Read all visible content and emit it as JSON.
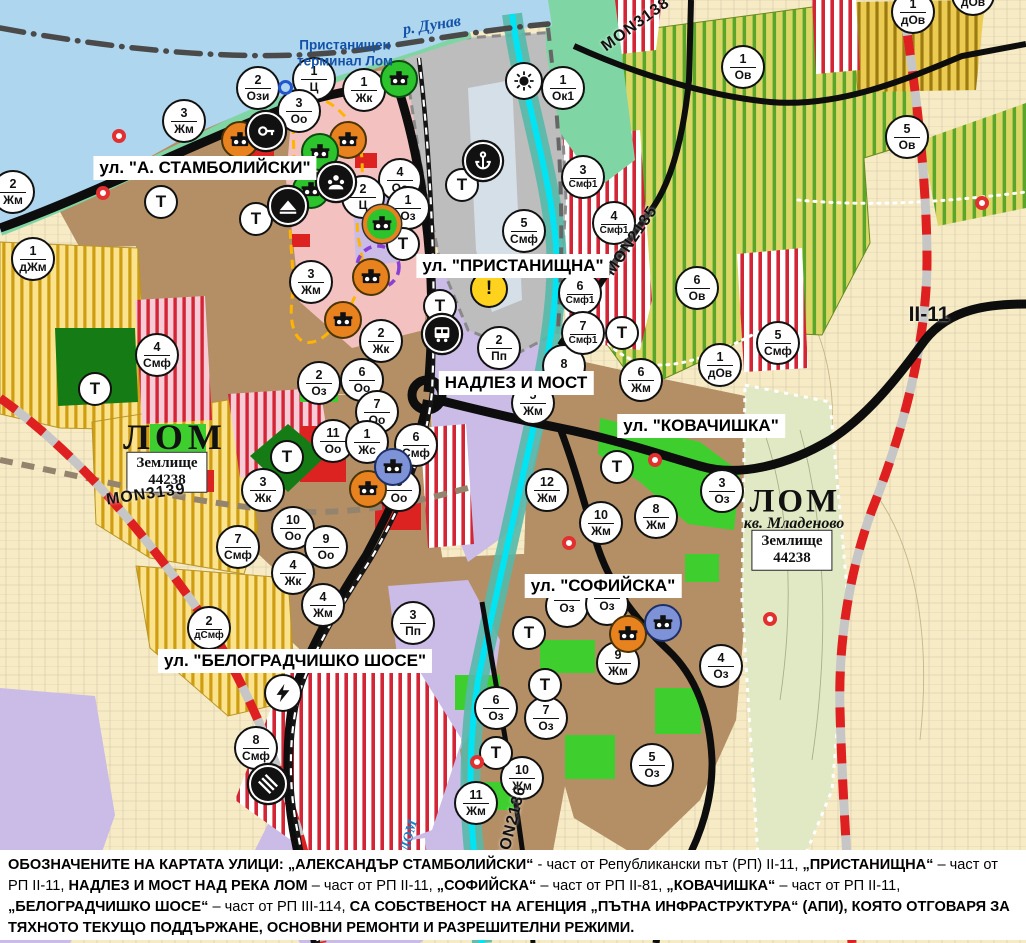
{
  "palette": {
    "water": "#aed6ee",
    "shore_green": "#7fd6a4",
    "urban_brown": "#b48f67",
    "pink_zone": "#f3c2c0",
    "agri_yellow": "#fbe28c",
    "agri_stripe": "#cf9d12",
    "vine_bg": "#dad766",
    "vine_stripe": "#5aa62a",
    "gold_bg": "#eccb52",
    "gold_stripe": "#9c7b10",
    "red_stripe": "#d32535",
    "lavender": "#cabbe7",
    "port_gray": "#bdbdbd",
    "bright_green": "#3ecf2e",
    "dark_green": "#157c15",
    "valley": "#e0e9c4",
    "beige": "#f6ebc5",
    "cyan_river": "#00e4f4",
    "teal_band": "#55b9a9",
    "road_black": "#0d0d0d",
    "border_red": "#df2020",
    "marker_orange": "#e8821e",
    "marker_green": "#2cc32c",
    "marker_blue": "#7e92d8"
  },
  "street_labels": [
    {
      "text": "ул. \"А. СТАМБОЛИЙСКИ\"",
      "x": 205,
      "y": 168
    },
    {
      "text": "ул. \"ПРИСТАНИЩНА\"",
      "x": 513,
      "y": 266
    },
    {
      "text": "НАДЛЕЗ И МОСТ",
      "x": 516,
      "y": 383
    },
    {
      "text": "ул. \"КОВАЧИШКА\"",
      "x": 701,
      "y": 426
    },
    {
      "text": "ул. \"СОФИЙСКА\"",
      "x": 603,
      "y": 586
    },
    {
      "text": "ул. \"БЕЛОГРАДЧИШКО ШОСЕ\"",
      "x": 295,
      "y": 661
    }
  ],
  "map_labels": [
    {
      "text": "р. Дунав",
      "cls": "river-name",
      "x": 432,
      "y": 26,
      "rot": -9
    },
    {
      "text": "Пристанищен\nтерминал Лом",
      "cls": "port-name",
      "x": 345,
      "y": 53,
      "rot": 0
    },
    {
      "text": "ЛОМ",
      "cls": "city-name",
      "x": 175,
      "y": 437,
      "rot": 0
    },
    {
      "text": "Землище\n44238",
      "cls": "landbox",
      "x": 167,
      "y": 472,
      "rot": 0
    },
    {
      "text": "MON3139",
      "cls": "road-name",
      "x": 146,
      "y": 495,
      "rot": -8
    },
    {
      "text": "ЛОМ",
      "cls": "city-name2",
      "x": 795,
      "y": 502,
      "rot": 0
    },
    {
      "text": "кв. Младеново",
      "cls": "quarter-name",
      "x": 794,
      "y": 524,
      "rot": 0
    },
    {
      "text": "Землище\n44238",
      "cls": "landbox",
      "x": 792,
      "y": 550,
      "rot": 0
    },
    {
      "text": "MON3138",
      "cls": "road-name",
      "x": 636,
      "y": 25,
      "rot": -36
    },
    {
      "text": "MON2135",
      "cls": "road-name",
      "x": 632,
      "y": 241,
      "rot": -56
    },
    {
      "text": "MON2136",
      "cls": "road-name",
      "x": 512,
      "y": 825,
      "rot": -76
    },
    {
      "text": "II-11",
      "cls": "road-name-big",
      "x": 929,
      "y": 315,
      "rot": 0
    },
    {
      "text": "ЛОМ",
      "cls": "river-name2",
      "x": 410,
      "y": 836,
      "rot": -75
    }
  ],
  "zone_markers": [
    {
      "x": 13,
      "y": 192,
      "num": "2",
      "code": "Жм"
    },
    {
      "x": 33,
      "y": 259,
      "num": "1",
      "code": "дЖм"
    },
    {
      "x": 184,
      "y": 121,
      "num": "3",
      "code": "Жм"
    },
    {
      "x": 258,
      "y": 88,
      "num": "2",
      "code": "Ози"
    },
    {
      "x": 314,
      "y": 79,
      "num": "1",
      "code": "Ц"
    },
    {
      "x": 299,
      "y": 111,
      "num": "3",
      "code": "Оо"
    },
    {
      "x": 364,
      "y": 90,
      "num": "1",
      "code": "Жк"
    },
    {
      "x": 400,
      "y": 180,
      "num": "4",
      "code": "Оо"
    },
    {
      "x": 363,
      "y": 197,
      "num": "2",
      "code": "Ц"
    },
    {
      "x": 408,
      "y": 208,
      "num": "1",
      "code": "Оз"
    },
    {
      "x": 311,
      "y": 282,
      "num": "3",
      "code": "Жм"
    },
    {
      "x": 381,
      "y": 341,
      "num": "2",
      "code": "Жк"
    },
    {
      "x": 157,
      "y": 355,
      "num": "4",
      "code": "Смф"
    },
    {
      "x": 319,
      "y": 383,
      "num": "2",
      "code": "Оз"
    },
    {
      "x": 362,
      "y": 380,
      "num": "6",
      "code": "Оо"
    },
    {
      "x": 377,
      "y": 412,
      "num": "7",
      "code": "Оо"
    },
    {
      "x": 333,
      "y": 441,
      "num": "11",
      "code": "Оо"
    },
    {
      "x": 367,
      "y": 442,
      "num": "1",
      "code": "Жс"
    },
    {
      "x": 416,
      "y": 445,
      "num": "6",
      "code": "Смф"
    },
    {
      "x": 399,
      "y": 490,
      "num": "8",
      "code": "Оо"
    },
    {
      "x": 293,
      "y": 528,
      "num": "10",
      "code": "Оо"
    },
    {
      "x": 326,
      "y": 547,
      "num": "9",
      "code": "Оо"
    },
    {
      "x": 293,
      "y": 573,
      "num": "4",
      "code": "Жк"
    },
    {
      "x": 238,
      "y": 547,
      "num": "7",
      "code": "Смф"
    },
    {
      "x": 263,
      "y": 490,
      "num": "3",
      "code": "Жк"
    },
    {
      "x": 499,
      "y": 348,
      "num": "2",
      "code": "Пп"
    },
    {
      "x": 533,
      "y": 403,
      "num": "5",
      "code": "Жм"
    },
    {
      "x": 564,
      "y": 366,
      "num": "8",
      "code": ""
    },
    {
      "x": 580,
      "y": 293,
      "num": "6",
      "code": "Смф1"
    },
    {
      "x": 583,
      "y": 333,
      "num": "7",
      "code": "Смф1"
    },
    {
      "x": 524,
      "y": 231,
      "num": "5",
      "code": "Смф"
    },
    {
      "x": 583,
      "y": 177,
      "num": "3",
      "code": "Смф1"
    },
    {
      "x": 614,
      "y": 223,
      "num": "4",
      "code": "Смф1"
    },
    {
      "x": 563,
      "y": 88,
      "num": "1",
      "code": "Ок1"
    },
    {
      "x": 697,
      "y": 288,
      "num": "6",
      "code": "Ов"
    },
    {
      "x": 720,
      "y": 365,
      "num": "1",
      "code": "дОв"
    },
    {
      "x": 743,
      "y": 67,
      "num": "1",
      "code": "Ов"
    },
    {
      "x": 907,
      "y": 137,
      "num": "5",
      "code": "Ов"
    },
    {
      "x": 913,
      "y": 12,
      "num": "1",
      "code": "дОв"
    },
    {
      "x": 973,
      "y": -6,
      "num": "1",
      "code": "дОв"
    },
    {
      "x": 641,
      "y": 380,
      "num": "6",
      "code": "Жм"
    },
    {
      "x": 547,
      "y": 490,
      "num": "12",
      "code": "Жм"
    },
    {
      "x": 601,
      "y": 523,
      "num": "10",
      "code": "Жм"
    },
    {
      "x": 656,
      "y": 517,
      "num": "8",
      "code": "Жм"
    },
    {
      "x": 722,
      "y": 491,
      "num": "3",
      "code": "Оз"
    },
    {
      "x": 618,
      "y": 663,
      "num": "9",
      "code": "Жм"
    },
    {
      "x": 721,
      "y": 666,
      "num": "4",
      "code": "Оз"
    },
    {
      "x": 652,
      "y": 765,
      "num": "5",
      "code": "Оз"
    },
    {
      "x": 567,
      "y": 606,
      "num": "",
      "code": "Оз"
    },
    {
      "x": 607,
      "y": 604,
      "num": "",
      "code": "Оз"
    },
    {
      "x": 496,
      "y": 708,
      "num": "6",
      "code": "Оз"
    },
    {
      "x": 546,
      "y": 718,
      "num": "7",
      "code": "Оз"
    },
    {
      "x": 522,
      "y": 778,
      "num": "10",
      "code": "Жм"
    },
    {
      "x": 476,
      "y": 803,
      "num": "11",
      "code": "Жм"
    },
    {
      "x": 209,
      "y": 628,
      "num": "2",
      "code": "дСмф"
    },
    {
      "x": 323,
      "y": 605,
      "num": "4",
      "code": "Жм"
    },
    {
      "x": 413,
      "y": 623,
      "num": "3",
      "code": "Пп"
    },
    {
      "x": 256,
      "y": 748,
      "num": "8",
      "code": "Смф"
    },
    {
      "x": 778,
      "y": 343,
      "num": "5",
      "code": "Смф"
    }
  ],
  "t_label": "Т",
  "t_markers": [
    {
      "x": 161,
      "y": 202
    },
    {
      "x": 256,
      "y": 219
    },
    {
      "x": 95,
      "y": 389
    },
    {
      "x": 287,
      "y": 457
    },
    {
      "x": 440,
      "y": 306
    },
    {
      "x": 403,
      "y": 244
    },
    {
      "x": 462,
      "y": 185
    },
    {
      "x": 622,
      "y": 333
    },
    {
      "x": 617,
      "y": 467
    },
    {
      "x": 529,
      "y": 633
    },
    {
      "x": 545,
      "y": 685
    },
    {
      "x": 496,
      "y": 753
    }
  ],
  "icon_markers": [
    {
      "x": 240,
      "y": 140,
      "type": "heritage-icon",
      "variant": "orange"
    },
    {
      "x": 348,
      "y": 140,
      "type": "heritage-icon",
      "variant": "orange"
    },
    {
      "x": 371,
      "y": 277,
      "type": "heritage-icon",
      "variant": "orange"
    },
    {
      "x": 343,
      "y": 320,
      "type": "heritage-icon",
      "variant": "orange"
    },
    {
      "x": 368,
      "y": 489,
      "type": "heritage-icon",
      "variant": "orange"
    },
    {
      "x": 628,
      "y": 634,
      "type": "heritage-icon",
      "variant": "orange"
    },
    {
      "x": 382,
      "y": 224,
      "type": "heritage-icon",
      "variant": "green-ring"
    },
    {
      "x": 320,
      "y": 152,
      "type": "heritage-icon",
      "variant": "green"
    },
    {
      "x": 311,
      "y": 190,
      "type": "heritage-icon",
      "variant": "green"
    },
    {
      "x": 399,
      "y": 79,
      "type": "heritage-icon",
      "variant": "green"
    },
    {
      "x": 393,
      "y": 467,
      "type": "heritage-icon",
      "variant": "blue"
    },
    {
      "x": 663,
      "y": 623,
      "type": "heritage-icon",
      "variant": "blue"
    },
    {
      "x": 266,
      "y": 131,
      "type": "key-icon",
      "variant": "black"
    },
    {
      "x": 336,
      "y": 182,
      "type": "people-icon",
      "variant": "black"
    },
    {
      "x": 288,
      "y": 206,
      "type": "mountain-icon",
      "variant": "black"
    },
    {
      "x": 483,
      "y": 161,
      "type": "anchor-icon",
      "variant": "black"
    },
    {
      "x": 442,
      "y": 334,
      "type": "bus-icon",
      "variant": "black"
    },
    {
      "x": 489,
      "y": 289,
      "type": "warning-icon",
      "variant": "yellow"
    },
    {
      "x": 524,
      "y": 81,
      "type": "sun-icon",
      "variant": "white"
    },
    {
      "x": 283,
      "y": 693,
      "type": "lightning-icon",
      "variant": "white"
    },
    {
      "x": 268,
      "y": 784,
      "type": "railcross-icon",
      "variant": "black"
    },
    {
      "x": 285,
      "y": 87,
      "type": "ring-icon",
      "variant": "ringblue"
    }
  ],
  "red_dots": [
    {
      "x": 119,
      "y": 136
    },
    {
      "x": 103,
      "y": 193
    },
    {
      "x": 982,
      "y": 203
    },
    {
      "x": 655,
      "y": 460
    },
    {
      "x": 569,
      "y": 543
    },
    {
      "x": 770,
      "y": 619
    },
    {
      "x": 477,
      "y": 762
    }
  ],
  "bottom_note": {
    "segments": [
      {
        "b": 1,
        "t": "ОБОЗНАЧЕНИТЕ НА КАРТАТА УЛИЦИ: „АЛЕКСАНДЪР СТАМБОЛИЙСКИ“"
      },
      {
        "b": 0,
        "t": " - част от Републикански път (РП) II-11, "
      },
      {
        "b": 1,
        "t": "„ПРИСТАНИЩНА“"
      },
      {
        "b": 0,
        "t": " – част от РП II-11, "
      },
      {
        "b": 1,
        "t": "НАДЛЕЗ И МОСТ НАД РЕКА ЛОМ"
      },
      {
        "b": 0,
        "t": " – част от РП II-11, "
      },
      {
        "b": 1,
        "t": "„СОФИЙСКА“"
      },
      {
        "b": 0,
        "t": " – част от РП II-81, "
      },
      {
        "b": 1,
        "t": "„КОВАЧИШКА“"
      },
      {
        "b": 0,
        "t": " – част от РП II-11, "
      },
      {
        "b": 1,
        "t": "„БЕЛОГРАДЧИШКО ШОСЕ“"
      },
      {
        "b": 0,
        "t": " – част от РП III-114, "
      },
      {
        "b": 1,
        "t": "СА СОБСТВЕНОСТ НА АГЕНЦИЯ „ПЪТНА ИНФРАСТРУКТУРА“ (АПИ), КОЯТО ОТГОВАРЯ ЗА ТЯХНОТО ТЕКУЩО ПОДДЪРЖАНЕ, ОСНОВНИ РЕМОНТИ И РАЗРЕШИТЕЛНИ РЕЖИМИ."
      }
    ]
  }
}
